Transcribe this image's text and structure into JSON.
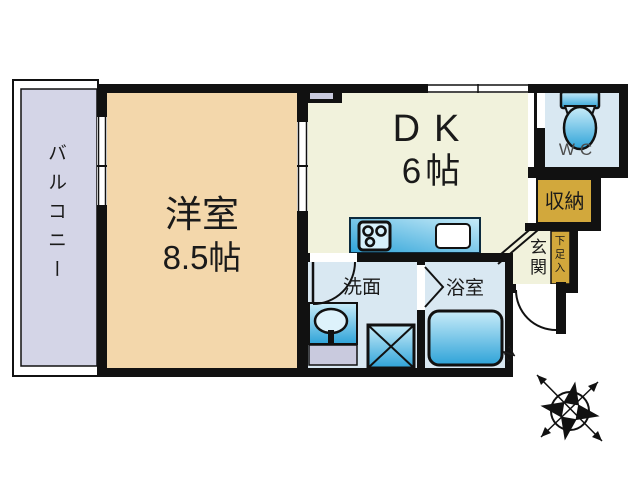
{
  "plan": {
    "balcony": "バルコニー",
    "western_room_name": "洋室",
    "western_room_size": "8.5帖",
    "dk_name": "DK",
    "dk_size": "6帖",
    "wc": "WC",
    "storage": "収納",
    "entrance": "玄関",
    "shoe_cabinet": "下足入",
    "washroom": "洗面",
    "bathroom": "浴室",
    "compass_north": "N"
  },
  "icons": {
    "toilet": "toilet-icon",
    "stove": "stove-icon",
    "kitchen_sink": "sink-icon",
    "washbasin": "washbasin-icon",
    "washing_machine": "washing-machine-icon",
    "bathtub": "bathtub-icon",
    "compass": "compass-rose-icon"
  },
  "colors": {
    "wall": "#111111",
    "balcony_fill": "#d4d5e7",
    "western_room_fill": "#f3d7ab",
    "dk_fill": "#f1f2dc",
    "wet_room_fill": "#d9e8f2",
    "storage_fill": "#d2a83c",
    "fixture_cyan_dark": "#2ea3d8",
    "fixture_cyan_light": "#c9ecf9",
    "fixture_pan_gray": "#c9cade"
  }
}
